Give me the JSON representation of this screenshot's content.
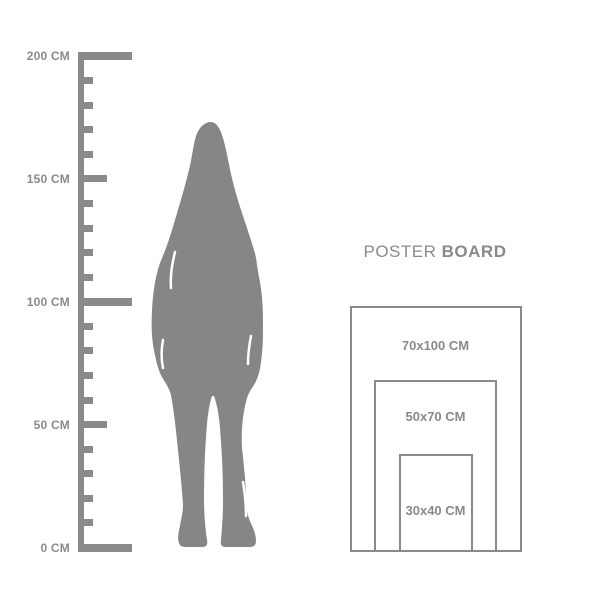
{
  "colors": {
    "gray": "#8a8a8a",
    "figure_gray": "#868686",
    "background": "#ffffff"
  },
  "ruler": {
    "unit_suffix": "CM",
    "min_cm": 0,
    "max_cm": 200,
    "minor_step_cm": 10,
    "major_step_cm": 50,
    "labels": [
      {
        "cm": 200,
        "text": "200 CM"
      },
      {
        "cm": 150,
        "text": "150 CM"
      },
      {
        "cm": 100,
        "text": "100 CM"
      },
      {
        "cm": 50,
        "text": "50 CM"
      },
      {
        "cm": 0,
        "text": "0 CM"
      }
    ]
  },
  "figure": {
    "description": "standing-woman-silhouette",
    "approx_height_cm": 173
  },
  "poster": {
    "title": {
      "regular": "POSTER",
      "bold": "BOARD"
    },
    "sizes": [
      {
        "label": "70x100 CM",
        "width_cm": 70,
        "height_cm": 100
      },
      {
        "label": "50x70 CM",
        "width_cm": 50,
        "height_cm": 70
      },
      {
        "label": "30x40 CM",
        "width_cm": 30,
        "height_cm": 40
      }
    ]
  }
}
